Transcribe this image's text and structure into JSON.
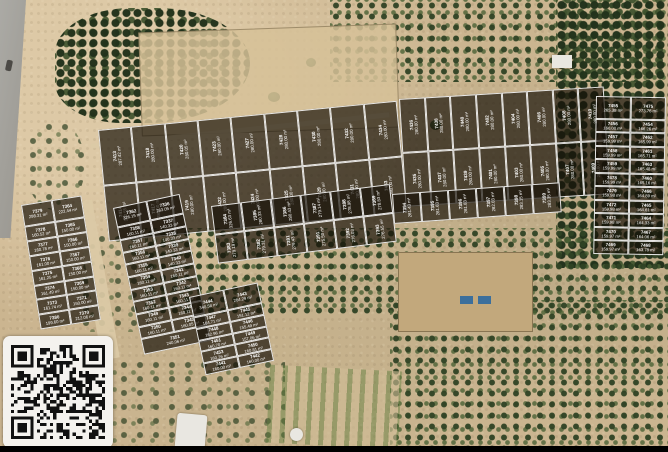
{
  "colors": {
    "plot_overlay": "rgba(22,16,8,0.68)",
    "plot_border": "#ffffff",
    "plot_text": "#ffffff",
    "sand": "#cbb590",
    "grove_green": "#3a5230",
    "road_gray": "#a3a19c",
    "qr_panel": "#f4f2ee",
    "bottom_bar": "#000000"
  },
  "unit": "m²",
  "icons": {
    "qr_code": "qr-code"
  },
  "blocks": {
    "strip_a1": {
      "rows": [
        [
          {
            "id": "7413",
            "area": "287.42 m²"
          },
          {
            "id": "7418",
            "area": "280.00 m²"
          },
          {
            "id": "7420",
            "area": "280.05 m²"
          },
          {
            "id": "7423",
            "area": "280.00 m²"
          },
          {
            "id": "7427",
            "area": "280.00 m²"
          },
          {
            "id": "7428",
            "area": "280.00 m²"
          },
          {
            "id": "7430",
            "area": "280.00 m²"
          },
          {
            "id": "7432",
            "area": "280.00 m²"
          },
          {
            "id": "7434",
            "area": "280.00 m²"
          }
        ],
        [
          {
            "id": "7414",
            "area": "360.55 m²"
          },
          {
            "id": "7417",
            "area": "280.00 m²"
          },
          {
            "id": "7419",
            "area": "280.00 m²"
          },
          {
            "id": "7422",
            "area": "280.00 m²"
          },
          {
            "id": "7424",
            "area": "280.00 m²"
          },
          {
            "id": "7425",
            "area": "280.00 m²"
          },
          {
            "id": "7429",
            "area": "280.00 m²"
          },
          {
            "id": "7431",
            "area": "280.00 m²"
          },
          {
            "id": "7433",
            "area": "280.00 m²"
          }
        ]
      ]
    },
    "strip_a2": {
      "rows": [
        [
          {
            "id": "7436",
            "area": "280.00 m²"
          },
          {
            "id": "7438",
            "area": "280.00 m²"
          },
          {
            "id": "7440",
            "area": "280.00 m²"
          },
          {
            "id": "7402",
            "area": "280.00 m²"
          },
          {
            "id": "7404",
            "area": "280.00 m²"
          },
          {
            "id": "7406",
            "area": "280.00 m²"
          },
          {
            "id": "7408",
            "area": "280.00 m²"
          },
          {
            "id": "7410",
            "area": "280.00 m²"
          }
        ],
        [
          {
            "id": "7435",
            "area": "280.00 m²"
          },
          {
            "id": "7437",
            "area": "280.00 m²"
          },
          {
            "id": "7439",
            "area": "280.00 m²"
          },
          {
            "id": "7401",
            "area": "280.00 m²"
          },
          {
            "id": "7403",
            "area": "280.00 m²"
          },
          {
            "id": "7405",
            "area": "280.00 m²"
          },
          {
            "id": "7407",
            "area": "280.00 m²"
          },
          {
            "id": "7409",
            "area": "280.00 m²"
          }
        ]
      ]
    },
    "strip_e1": {
      "rows": [
        [
          {
            "id": "7384",
            "area": "326.63 m²"
          },
          {
            "id": "7385",
            "area": "280.33 m²"
          },
          {
            "id": "7386",
            "area": "280.43 m²"
          },
          {
            "id": "7387",
            "area": "279.14 m²"
          },
          {
            "id": "7388",
            "area": "278.98 m²"
          },
          {
            "id": "7389",
            "area": "278.83 m²"
          }
        ],
        [
          {
            "id": "7383",
            "area": "279.19 m²"
          },
          {
            "id": "7382",
            "area": "279.31 m²"
          },
          {
            "id": "7381",
            "area": "279.43 m²"
          },
          {
            "id": "7391",
            "area": "275.50 m²"
          },
          {
            "id": "7392",
            "area": "276.03 m²"
          },
          {
            "id": "7393",
            "area": "276.55 m²"
          }
        ]
      ]
    },
    "strip_e2": {
      "rows": [
        [
          {
            "id": "7394",
            "area": "281.43 m²"
          },
          {
            "id": "7395",
            "area": "281.63 m²"
          },
          {
            "id": "7396",
            "area": "281.83 m²"
          },
          {
            "id": "7397",
            "area": "282.03 m²"
          },
          {
            "id": "7398",
            "area": "283.15 m²"
          },
          {
            "id": "7399",
            "area": "283.35 m²"
          }
        ]
      ]
    },
    "block_b": {
      "rows": [
        [
          {
            "id": "7455",
            "area": "265.38 m²"
          },
          {
            "id": "7475",
            "area": "273.76 m²"
          }
        ],
        [
          {
            "id": "7456",
            "area": "160.00 m²"
          },
          {
            "id": "7454",
            "area": "166.26 m²"
          }
        ],
        [
          {
            "id": "7457",
            "area": "159.99 m²"
          },
          {
            "id": "7462",
            "area": "165.99 m²"
          }
        ],
        [
          {
            "id": "7458",
            "area": "159.99 m²"
          },
          {
            "id": "7461",
            "area": "165.71 m²"
          }
        ],
        [
          {
            "id": "7459",
            "area": "159.99 m²"
          },
          {
            "id": "7463",
            "area": "165.48 m²"
          }
        ],
        [
          {
            "id": "7478",
            "area": "159.99 m²"
          },
          {
            "id": "7460",
            "area": "165.16 m²"
          }
        ],
        [
          {
            "id": "7479",
            "area": "159.98 m²"
          },
          {
            "id": "7466",
            "area": "164.89 m²"
          }
        ],
        [
          {
            "id": "7472",
            "area": "159.98 m²"
          },
          {
            "id": "7465",
            "area": "164.61 m²"
          }
        ],
        [
          {
            "id": "7471",
            "area": "159.98 m²"
          },
          {
            "id": "7464",
            "area": "164.33 m²"
          }
        ],
        [
          {
            "id": "7470",
            "area": "159.97 m²"
          },
          {
            "id": "7467",
            "area": "164.06 m²"
          }
        ],
        [
          {
            "id": "7469",
            "area": "159.97 m²"
          },
          {
            "id": "7468",
            "area": "163.78 m²"
          }
        ]
      ]
    },
    "block_c": {
      "rows": [
        [
          {
            "id": "7379",
            "area": "298.31 m²"
          },
          {
            "id": "7364",
            "area": "222.44 m²"
          }
        ],
        [
          {
            "id": "7378",
            "area": "160.52 m²"
          },
          {
            "id": "7365",
            "area": "150.00 m²"
          }
        ],
        [
          {
            "id": "7377",
            "area": "160.78 m²"
          },
          {
            "id": "7366",
            "area": "150.00 m²"
          }
        ],
        [
          {
            "id": "7376",
            "area": "161.00 m²"
          },
          {
            "id": "7367",
            "area": "150.00 m²"
          }
        ],
        [
          {
            "id": "7375",
            "area": "161.25 m²"
          },
          {
            "id": "7368",
            "area": "150.00 m²"
          }
        ],
        [
          {
            "id": "7374",
            "area": "161.49 m²"
          },
          {
            "id": "7369",
            "area": "150.00 m²"
          }
        ],
        [
          {
            "id": "7373",
            "area": "161.74 m²"
          },
          {
            "id": "7371",
            "area": "150.00 m²"
          }
        ],
        [
          {
            "id": "7380",
            "area": "199.60 m²"
          },
          {
            "id": "7370",
            "area": "212.06 m²"
          }
        ]
      ]
    },
    "block_d": {
      "rows": [
        [
          {
            "id": "7362",
            "area": "326.15 m²"
          },
          {
            "id": "7336",
            "area": "263.05 m²"
          }
        ],
        [
          {
            "id": "7358",
            "area": "160.11 m²"
          },
          {
            "id": "7337",
            "area": "140.33 m²"
          }
        ],
        [
          {
            "id": "7357",
            "area": "160.11 m²"
          },
          {
            "id": "7338",
            "area": "140.33 m²"
          }
        ],
        [
          {
            "id": "7356",
            "area": "160.11 m²"
          },
          {
            "id": "7339",
            "area": "140.33 m²"
          }
        ],
        [
          {
            "id": "7355",
            "area": "160.11 m²"
          },
          {
            "id": "7340",
            "area": "140.33 m²"
          }
        ],
        [
          {
            "id": "7354",
            "area": "160.11 m²"
          },
          {
            "id": "7341",
            "area": "160.11 m²"
          }
        ],
        [
          {
            "id": "7353",
            "area": "160.11 m²"
          },
          {
            "id": "7342",
            "area": "160.11 m²"
          }
        ],
        [
          {
            "id": "7352",
            "area": "160.11 m²"
          },
          {
            "id": "7343",
            "area": "160.11 m²"
          }
        ],
        [
          {
            "id": "7349",
            "area": "160.11 m²"
          },
          {
            "id": "7344",
            "area": "160.11 m²"
          }
        ],
        [
          {
            "id": "7350",
            "area": "160.11 m²"
          },
          {
            "id": "7345",
            "area": "160.05 m²"
          }
        ],
        [
          {
            "id": "7351",
            "area": "240.06 m²"
          }
        ]
      ]
    },
    "block_f": {
      "rows": [
        [
          {
            "id": "7444",
            "area": "340.58 m²"
          },
          {
            "id": "7443",
            "area": "284.29 m²"
          }
        ],
        [
          {
            "id": "7447",
            "area": "164.71 m²"
          },
          {
            "id": "7445",
            "area": "151.12 m²"
          }
        ],
        [
          {
            "id": "7448",
            "area": "162.96 m²"
          },
          {
            "id": "7446",
            "area": "155.49 m²"
          }
        ],
        [
          {
            "id": "7451",
            "area": "160.70 m²"
          },
          {
            "id": "7449",
            "area": "157.06 m²"
          }
        ],
        [
          {
            "id": "7453",
            "area": "160.26 m²"
          },
          {
            "id": "7450",
            "area": "160.81 m²"
          }
        ],
        [
          {
            "id": "7441",
            "area": "160.00 m²"
          },
          {
            "id": "7442",
            "area": "160.00 m²"
          }
        ]
      ]
    }
  }
}
